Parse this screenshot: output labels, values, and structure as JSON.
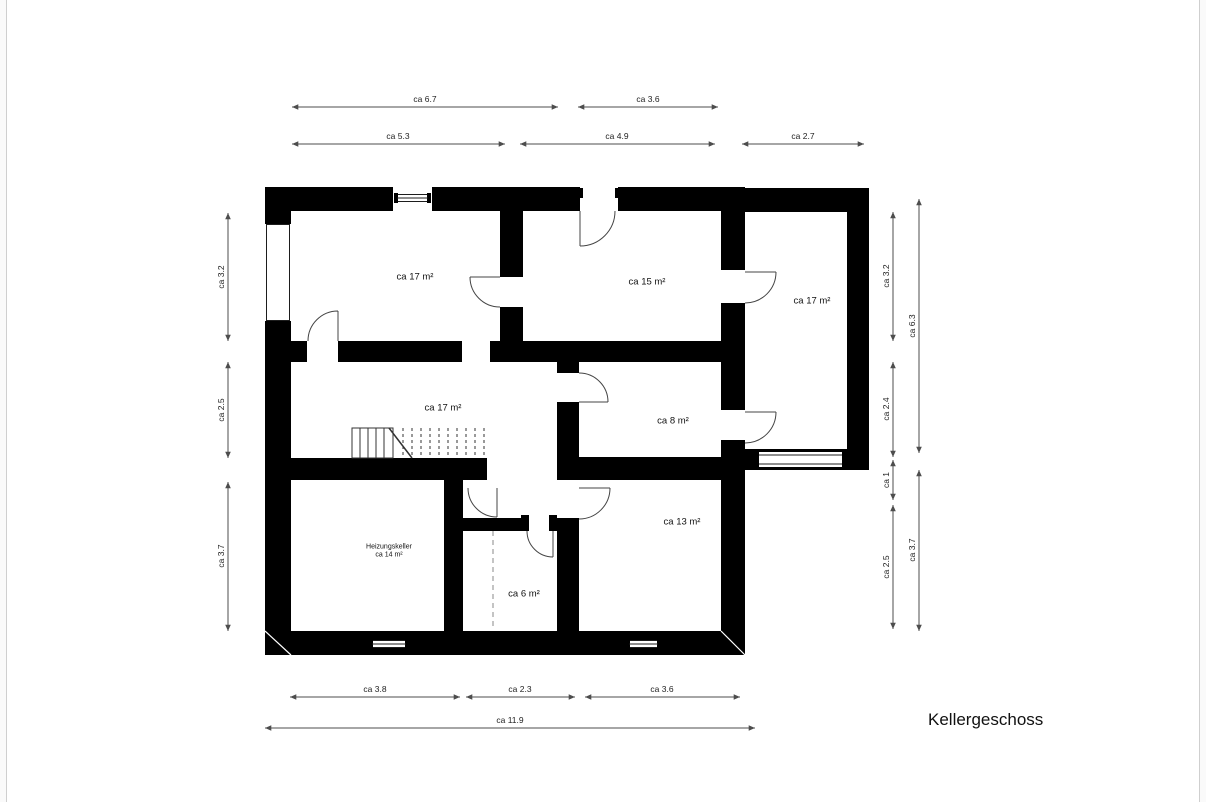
{
  "title": "Kellergeschoss",
  "rooms": {
    "top_left": "ca 17 m²",
    "top_middle": "ca 15 m²",
    "right_wing": "ca 17 m²",
    "stair_room": "ca 17 m²",
    "room8": "ca 8 m²",
    "heizung_line1": "Heizungskeller",
    "heizung_line2": "ca 14 m²",
    "room6": "ca 6 m²",
    "room13": "ca 13 m²"
  },
  "dims": {
    "top1a": "ca 6.7",
    "top1b": "ca 3.6",
    "top2a": "ca 5.3",
    "top2b": "ca 4.9",
    "top2c": "ca 2.7",
    "left1": "ca 3.2",
    "left2": "ca 2.5",
    "left3": "ca 3.7",
    "right_inner1": "ca 3.2",
    "right_inner2": "ca 2.4",
    "right_inner3": "ca 1",
    "right_inner4": "ca 2.5",
    "right_outer1": "ca 6.3",
    "right_outer2": "ca 3.7",
    "bottom1a": "ca 3.8",
    "bottom1b": "ca 2.3",
    "bottom1c": "ca 3.6",
    "bottom2": "ca 11.9"
  },
  "colors": {
    "wall": "#000000",
    "line": "#4d4d4d",
    "background": "#ffffff"
  }
}
